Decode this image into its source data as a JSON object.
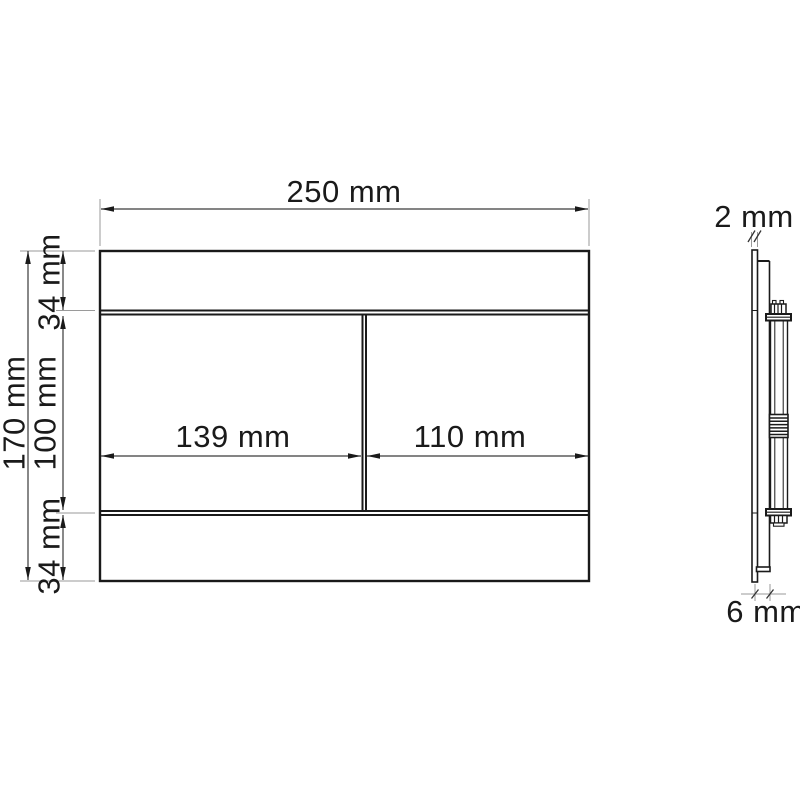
{
  "drawing": {
    "type": "technical-dimension-drawing",
    "colors": {
      "background": "#ffffff",
      "outline": "#1a1a1a",
      "dimension_line": "#3a3a3a",
      "extension_line": "#9a9a9a",
      "text": "#1a1a1a"
    },
    "front_view": {
      "overall_width_label": "250 mm",
      "overall_height_label": "170 mm",
      "top_strip_height_label": "34 mm",
      "button_area_height_label": "100 mm",
      "bottom_strip_height_label": "34 mm",
      "left_button_width_label": "139 mm",
      "right_button_width_label": "110 mm"
    },
    "side_view": {
      "plate_thickness_label": "2 mm",
      "bottom_depth_label": "6 mm"
    }
  }
}
